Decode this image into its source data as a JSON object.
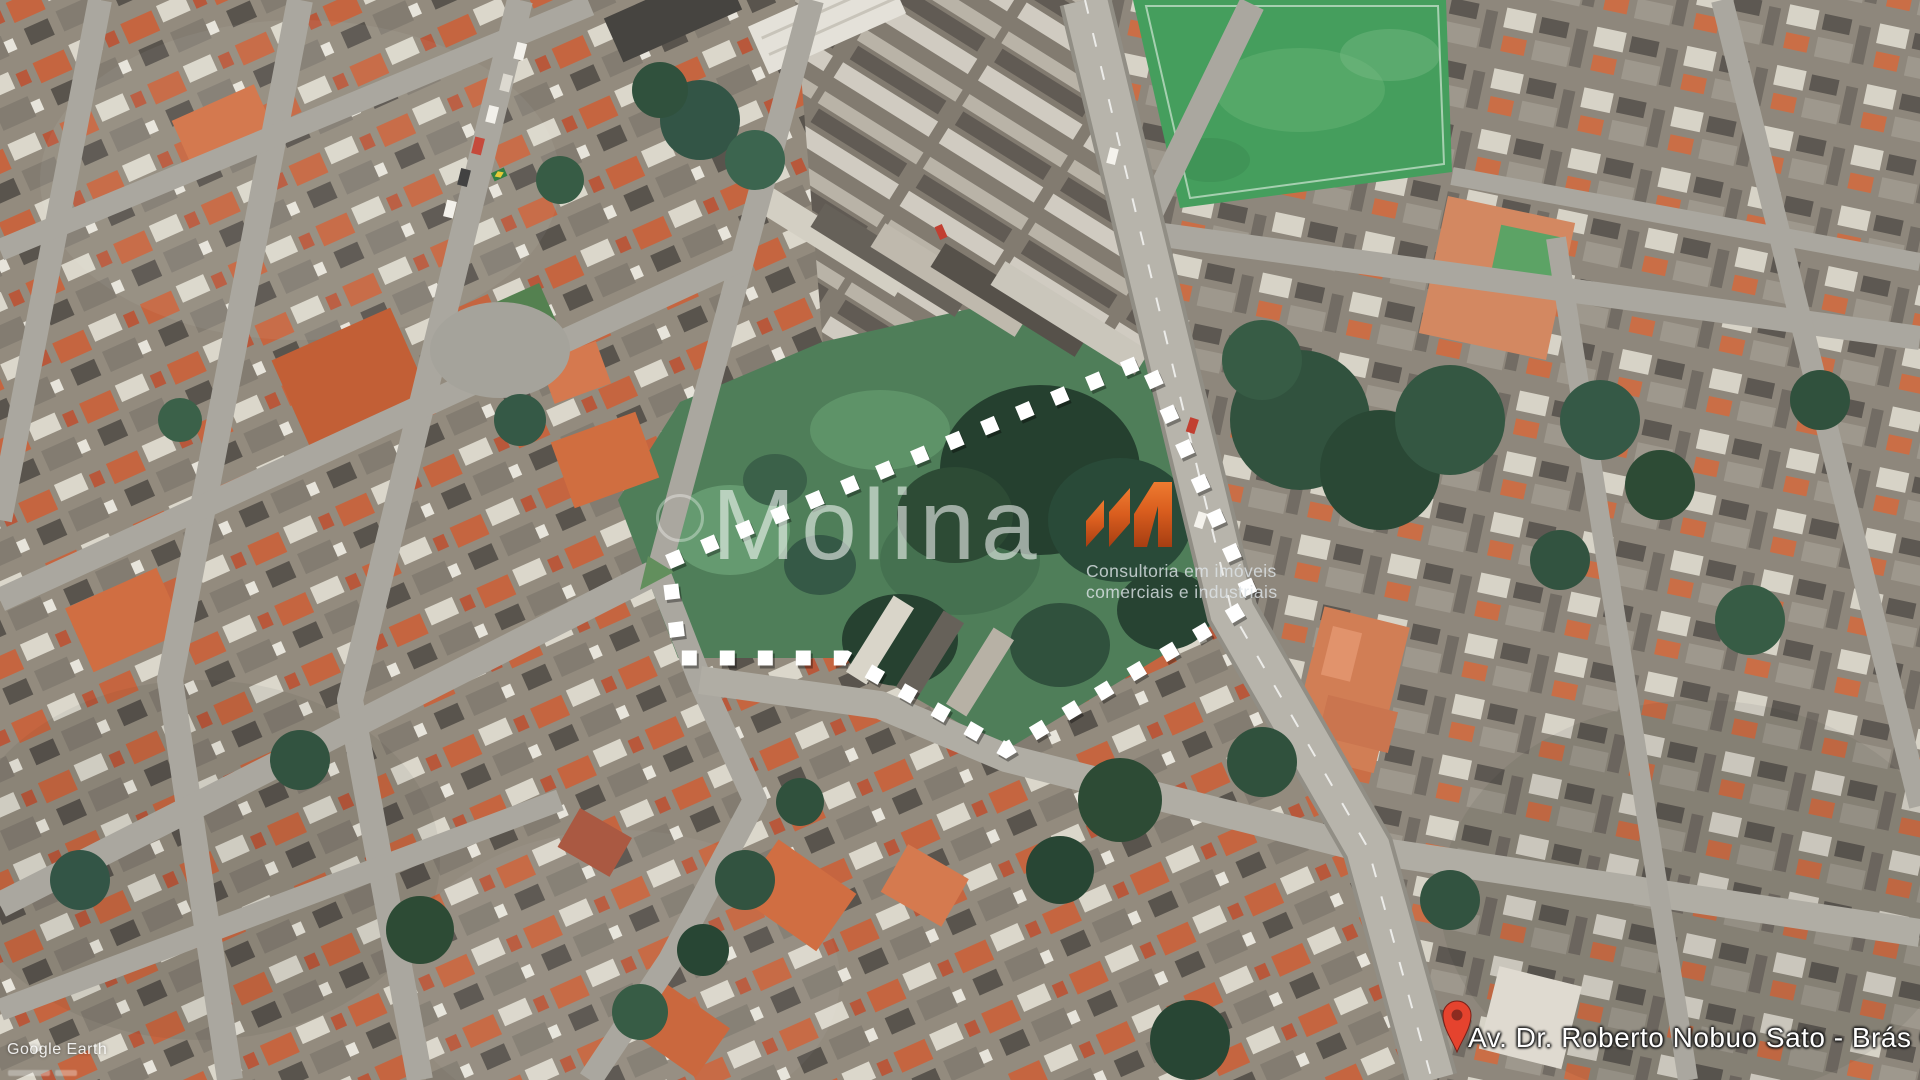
{
  "window": {
    "width": 1920,
    "height": 1080,
    "view": "aerial satellite"
  },
  "map": {
    "provider_watermark": "Google Earth",
    "street_label": "Av. Dr. Roberto Nobuo Sato - Brás Cubas",
    "pin_color": "#e5432e",
    "boundary": {
      "color": "#ffffff",
      "style": "dashed",
      "points": "668,562 1145,360 1254,602 1132,674 1006,750 846,658 680,658"
    },
    "colors": {
      "soccer_field_green": "#3f9b58",
      "property_lot_green": "#4a7a54",
      "tree_dark_green": "#22402e",
      "road_gray": "#aaa79e",
      "avenue_gray": "#b5b2a9",
      "roof_orange": "#c4613a",
      "roof_light": "#dad6ca",
      "roof_dark": "#544f48"
    }
  },
  "branding": {
    "name": "Molina",
    "tagline_line1": "Consultoria em imóveis",
    "tagline_line2": "comerciais e industriais",
    "logo_orange_dark": "#a63e12",
    "logo_orange_light": "#ee7b30",
    "watermark_text_color": "rgba(255,255,255,0.55)"
  }
}
